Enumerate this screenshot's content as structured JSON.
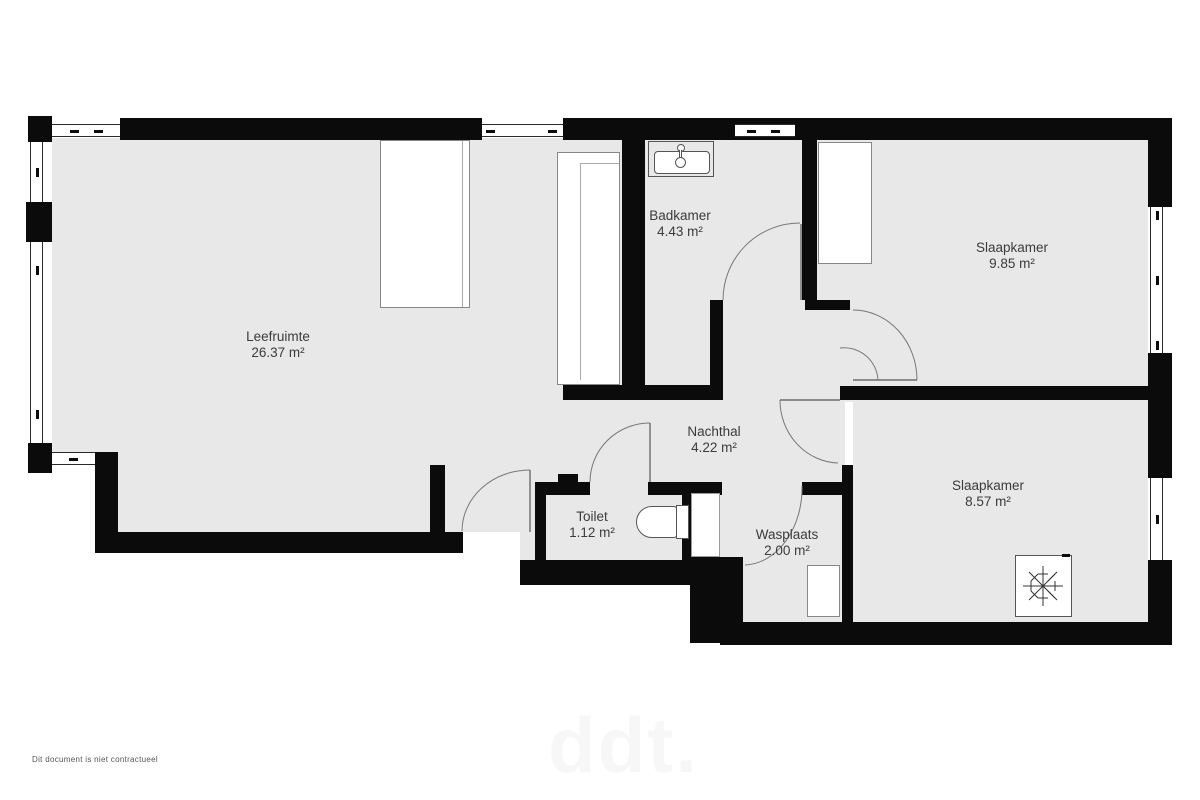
{
  "title": "Appartement plattegrond",
  "rooms": [
    {
      "name": "Leefruimte",
      "area": "26.37 m²"
    },
    {
      "name": "Badkamer",
      "area": "4.43 m²"
    },
    {
      "name": "Slaapkamer",
      "area": "9.85 m²"
    },
    {
      "name": "Nachthal",
      "area": "4.22 m²"
    },
    {
      "name": "Toilet",
      "area": "1.12 m²"
    },
    {
      "name": "Wasplaats",
      "area": "2.00 m²"
    },
    {
      "name": "Slaapkamer",
      "area": "8.57 m²"
    }
  ],
  "footer": {
    "disclaimer": "Dit document is niet contractueel"
  },
  "watermark": {
    "text": "ddt."
  },
  "colors": {
    "wall": "#0b0b0b",
    "floor": "#e8e8e8",
    "background": "#ffffff",
    "door_line": "#666666",
    "label_text": "#3b3b3b"
  }
}
